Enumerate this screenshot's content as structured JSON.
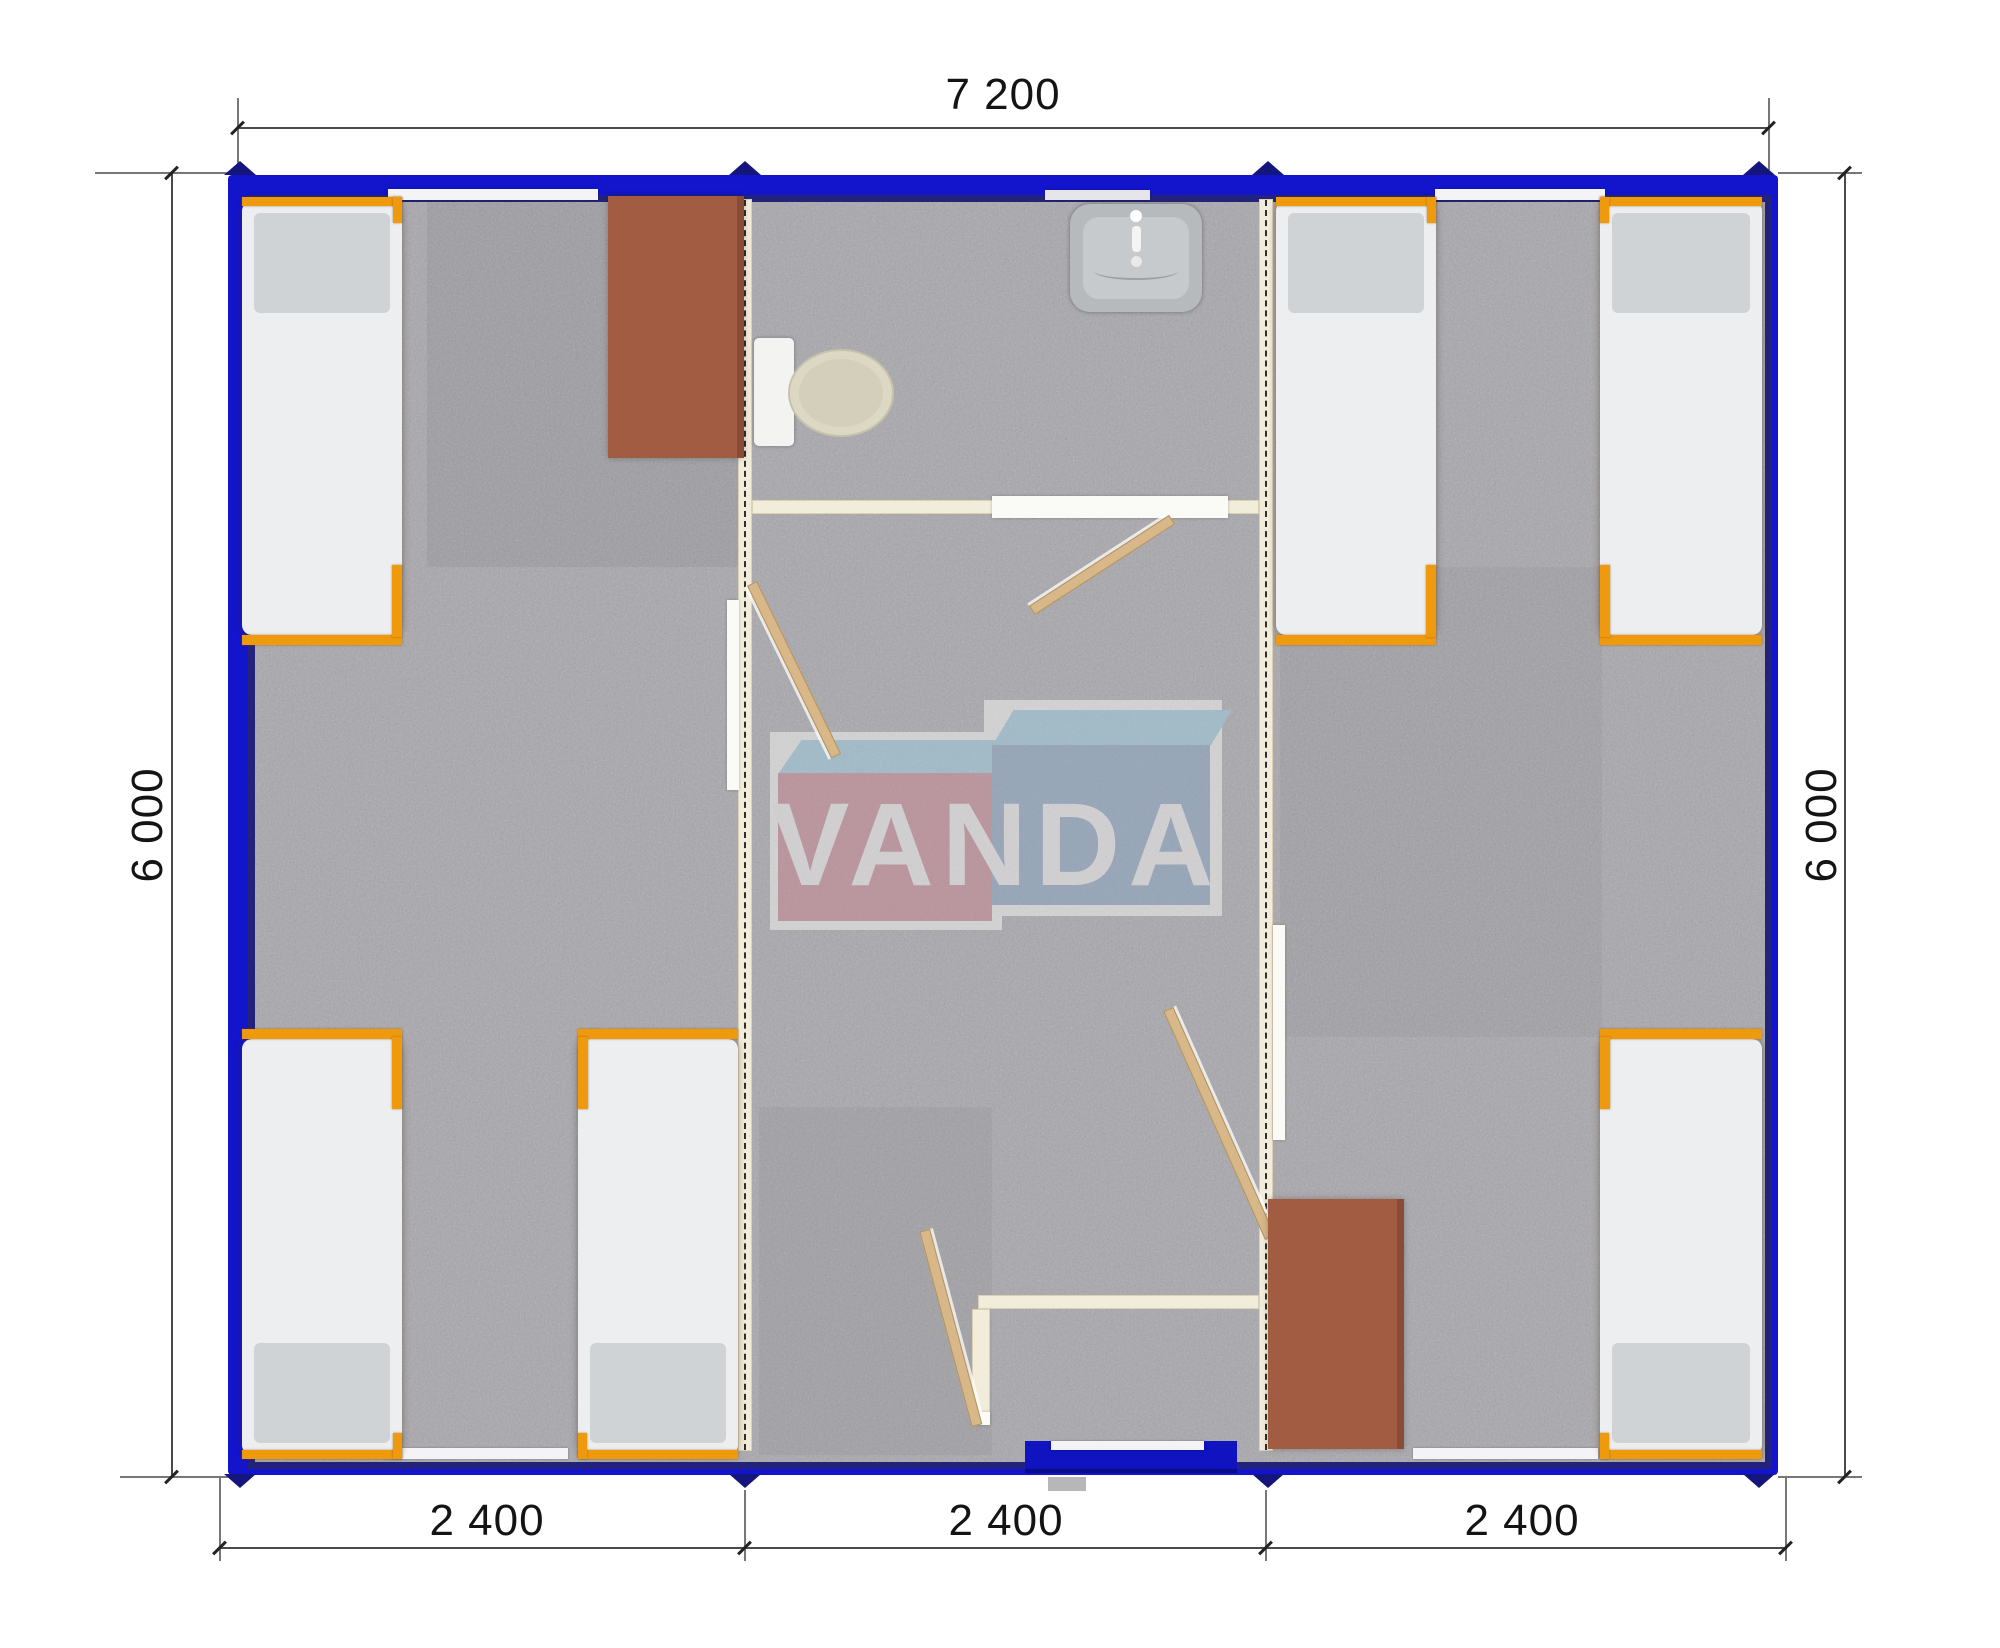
{
  "plan": {
    "type": "modular-container-house-floor-plan",
    "dimensions": {
      "top": "7 200",
      "left": "6 000",
      "right": "6 000",
      "bottom": [
        "2 400",
        "2 400",
        "2 400"
      ]
    },
    "watermark": {
      "text": "VANDA"
    },
    "rooms": {
      "modules": 3,
      "bed_count": 6,
      "table_count": 2,
      "bathroom_fixtures": [
        "toilet",
        "sink"
      ]
    },
    "colors": {
      "frame_blue": "#1315cd",
      "frame_blue_dark": "#23237c",
      "interior_wall_cream": "#f2ecda",
      "floor_gray": "#a8a7ac",
      "bed_frame_orange": "#ef9a0d",
      "mattress_white": "#edeef0",
      "pillow_gray": "#d0d3d6",
      "table_brown": "#a25c41",
      "door_wood": "#d8b888",
      "logo_pink": "#c78793",
      "logo_steel_blue": "#8aa5c1",
      "logo_light_blue": "#9dc9dc",
      "dimension_text": "#141414"
    }
  }
}
